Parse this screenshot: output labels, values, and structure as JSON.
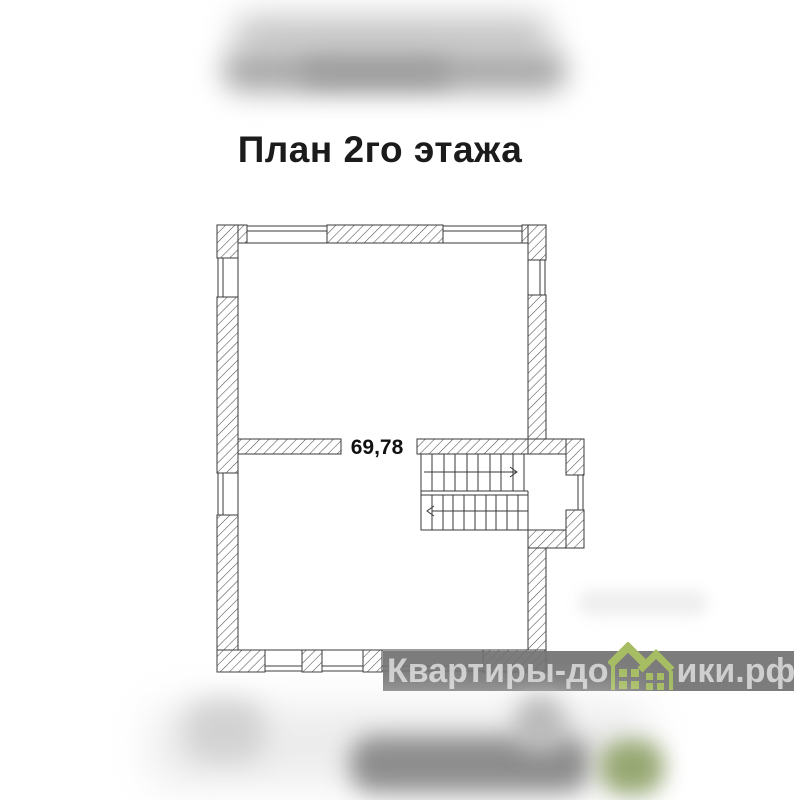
{
  "title": {
    "text": "План 2го этажа",
    "color": "#1b1b1b"
  },
  "floor_plan": {
    "area_label": "69,78",
    "line_color": "#3a3a3a",
    "hatch_color": "#4e4e4e",
    "background": "#ffffff"
  },
  "watermark": {
    "full_text": "Квартиры-домики.рф",
    "text_left": "Квартиры-до",
    "text_right": "ики.рф",
    "band_color": "#717171",
    "text_color": "#cfcfcf",
    "house_icon_color": "#a6bd63"
  }
}
